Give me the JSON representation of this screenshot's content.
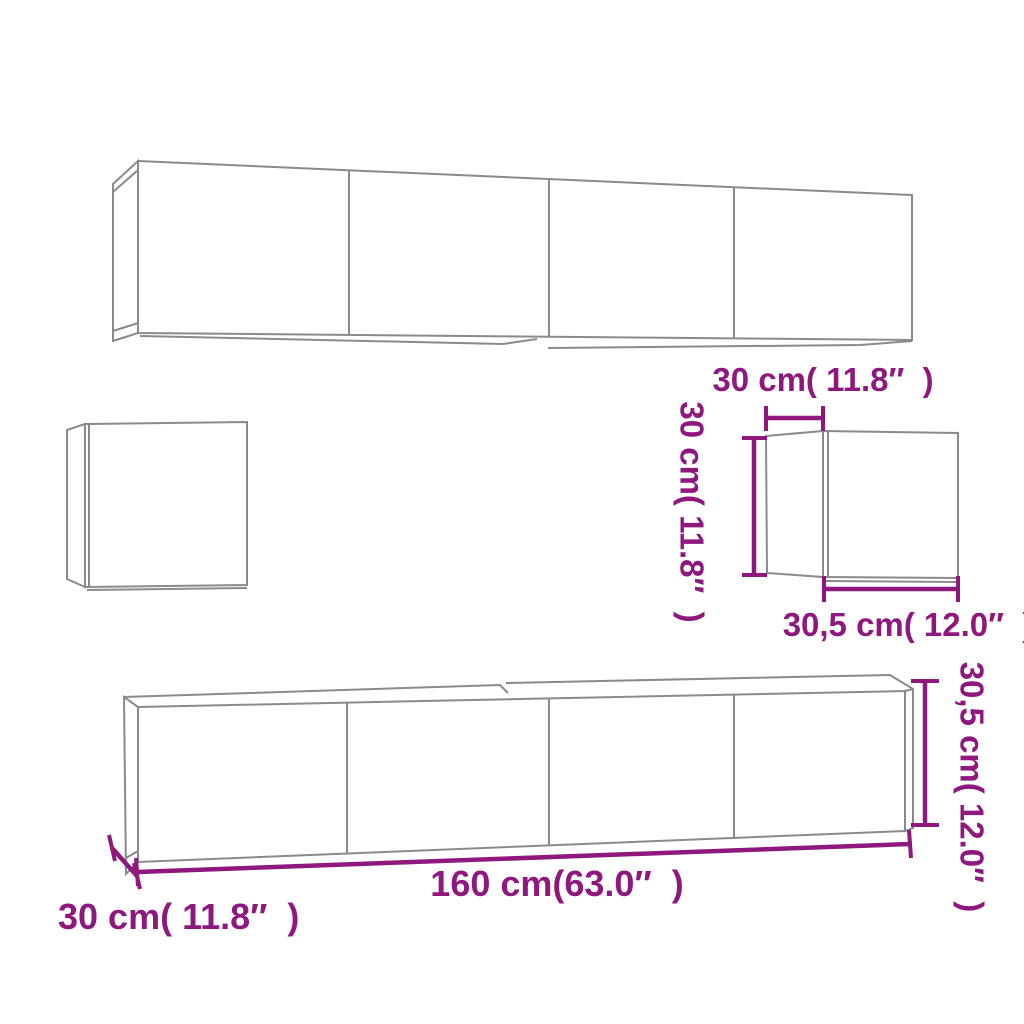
{
  "diagram": {
    "type": "furniture-dimension-diagram",
    "figures": [
      "top-wall-cabinet-row",
      "small-square-wall-cabinet",
      "small-cube-wall-cabinet",
      "bottom-tv-cabinet-row"
    ],
    "labels": {
      "cube_width_top": "30 cm( 11.8″  )",
      "cube_height_left": "30 cm( 11.8″  )",
      "cube_depth_bottom": "30,5 cm( 12.0″  )",
      "long_cabinet_width": "160 cm(63.0″  )",
      "long_cabinet_depth": "30 cm( 11.8″  )",
      "long_cabinet_height": "30,5 cm( 12.0″  )"
    },
    "colors": {
      "dimension_annotation": "#8E187E",
      "cabinet_outline": "#8A8A8A",
      "background": "#FFFFFF"
    }
  }
}
